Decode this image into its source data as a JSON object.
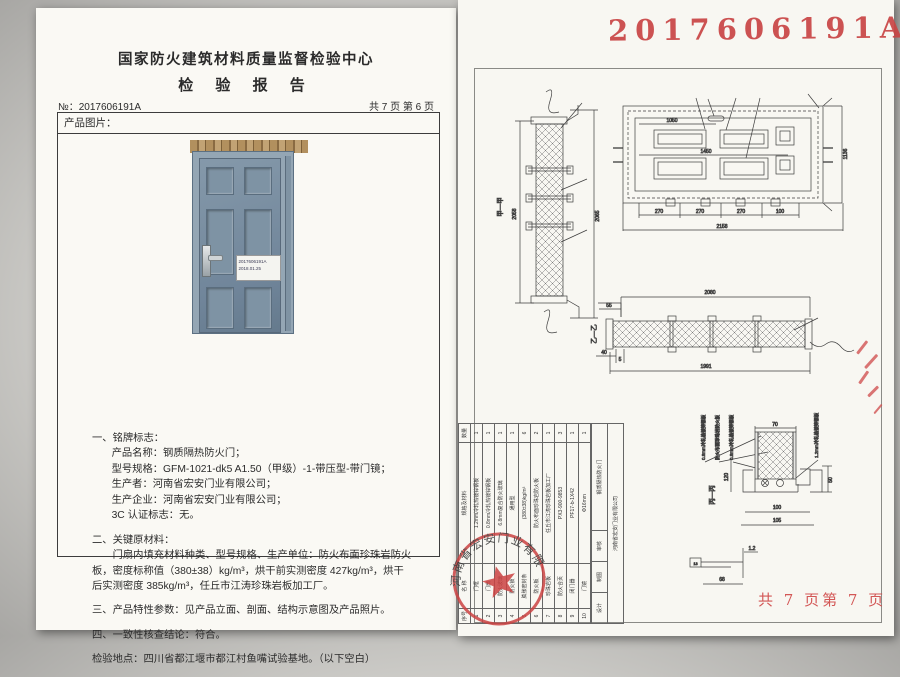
{
  "report": {
    "center_name": "国家防火建筑材料质量监督检验中心",
    "title": "检 验 报 告",
    "report_no": "№：2017606191A",
    "page_info": "共 7 页 第 6 页",
    "product_image_label": "产品图片：",
    "photo_tag_line1": "2017606191A",
    "photo_tag_line2": "2018.01.25",
    "s1_title": "一、铭牌标志：",
    "s1_lines": [
      "产品名称：钢质隔热防火门；",
      "型号规格：GFM-1021-dk5 A1.50（甲级）-1-带压型-带门镜；",
      "生产者：河南省宏安门业有限公司；",
      "生产企业：河南省宏安门业有限公司；",
      "3C 认证标志：无。"
    ],
    "s2_title": "二、关键原材料：",
    "s2_body": "门扇内填充材料种类、型号规格、生产单位：防火布面珍珠岩防火板，密度标称值（380±38）kg/m³，烘干前实测密度 427kg/m³，烘干后实测密度 385kg/m³，任丘市江涛珍珠岩板加工厂。",
    "s3": "三、产品特性参数：见产品立面、剖面、结构示意图及产品照片。",
    "s4": "四、一致性核查结论：符合。",
    "location": "检验地点：四川省都江堰市都江村鱼嘴试验基地。（以下空白）"
  },
  "drawing": {
    "stamp_number": "2017606191A",
    "footer_pages": "共 7 页第 7 页",
    "labels": {
      "jia": "甲—甲",
      "yi": "乙—乙",
      "bing": "丙—丙"
    },
    "vsec": {
      "left": "2058",
      "right": "2065"
    },
    "elev": {
      "top": "1050",
      "mid": "1450",
      "b1": "270",
      "b2": "270",
      "b3": "270",
      "b4": "100",
      "total": "2158",
      "height": "1136"
    },
    "hsec": {
      "top": "2080",
      "s55": "55",
      "s40": "40",
      "s5": "5",
      "bottom": "1991"
    },
    "det": {
      "w70": "70",
      "h50": "50",
      "v120": "120",
      "b100": "100",
      "b105": "105",
      "p13": "13",
      "p68": "68",
      "p12": "1.2"
    },
    "materials": [
      "0.8mm冷轧热镀锌钢板",
      "防火布面珍珠岩防火板",
      "0.8mm冷轧热镀锌钢板",
      "1.2mm冷轧热镀锌钢板"
    ],
    "seal_text": "河南省宏安门业有限公司",
    "table": {
      "headers": [
        "序号",
        "名 称",
        "规格及材料",
        "数量"
      ],
      "rows": [
        [
          "1",
          "门框",
          "1.2mm冷轧热镀锌钢板",
          "1"
        ],
        [
          "2",
          "门扇",
          "0.8mm冷轧热镀锌钢板",
          "1"
        ],
        [
          "3",
          "防火玻璃",
          "6.8mm复合防火玻璃",
          "1"
        ],
        [
          "4",
          "防火锁",
          "通用型",
          "1"
        ],
        [
          "5",
          "膨胀密封条",
          "(380±38)kg/m³",
          "6"
        ],
        [
          "6",
          "防火板",
          "防火布面珍珠岩防火板",
          "2"
        ],
        [
          "7",
          "珍珠岩板",
          "任丘市江涛珍珠岩板加工厂",
          "1"
        ],
        [
          "8",
          "防火合页",
          "PX3-900-9853",
          "3"
        ],
        [
          "9",
          "闭门器",
          "PF17-b-1X42",
          "1"
        ],
        [
          "10",
          "门镜",
          "Φ16mm",
          "1"
        ]
      ],
      "footer": [
        "设计",
        "制图",
        "审核",
        "钢质隔热防火门",
        "河南省宏安门业有限公司"
      ]
    }
  }
}
